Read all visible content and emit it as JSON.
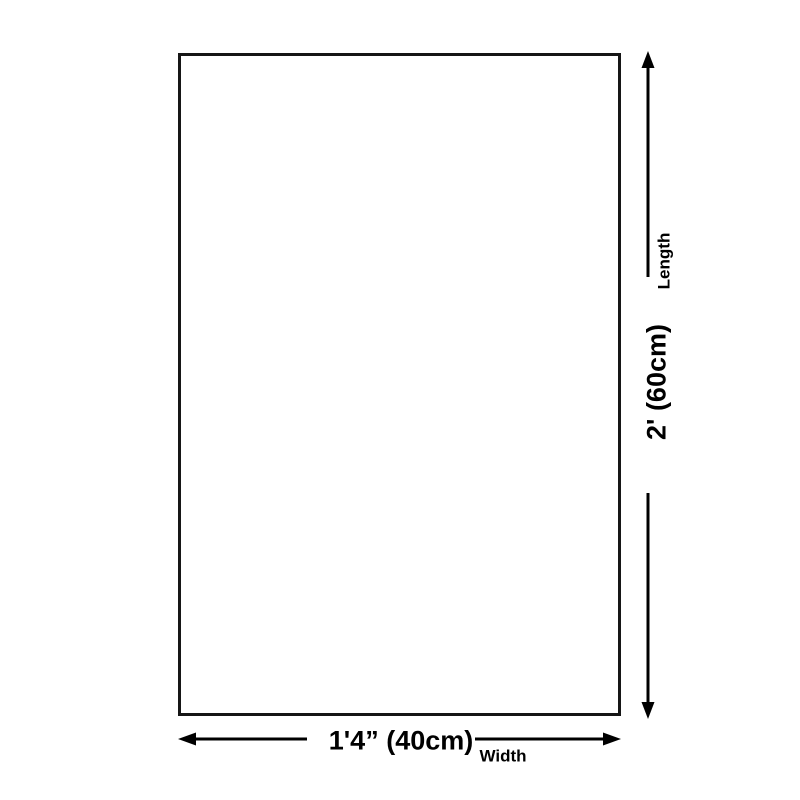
{
  "diagram": {
    "type": "product-size-diagram",
    "dimensions": {
      "length": {
        "label": "Length",
        "value": "2' (60cm)",
        "orientation": "vertical"
      },
      "width": {
        "label": "Width",
        "value": "1'4” (40cm)",
        "orientation": "horizontal"
      }
    }
  },
  "icons": {
    "arrow_up": "arrow-up-icon",
    "arrow_down": "arrow-down-icon",
    "arrow_left": "arrow-left-icon",
    "arrow_right": "arrow-right-icon"
  },
  "colors": {
    "background": "#ffffff",
    "box_border": "#161616",
    "line": "#000000",
    "text": "#000000"
  }
}
